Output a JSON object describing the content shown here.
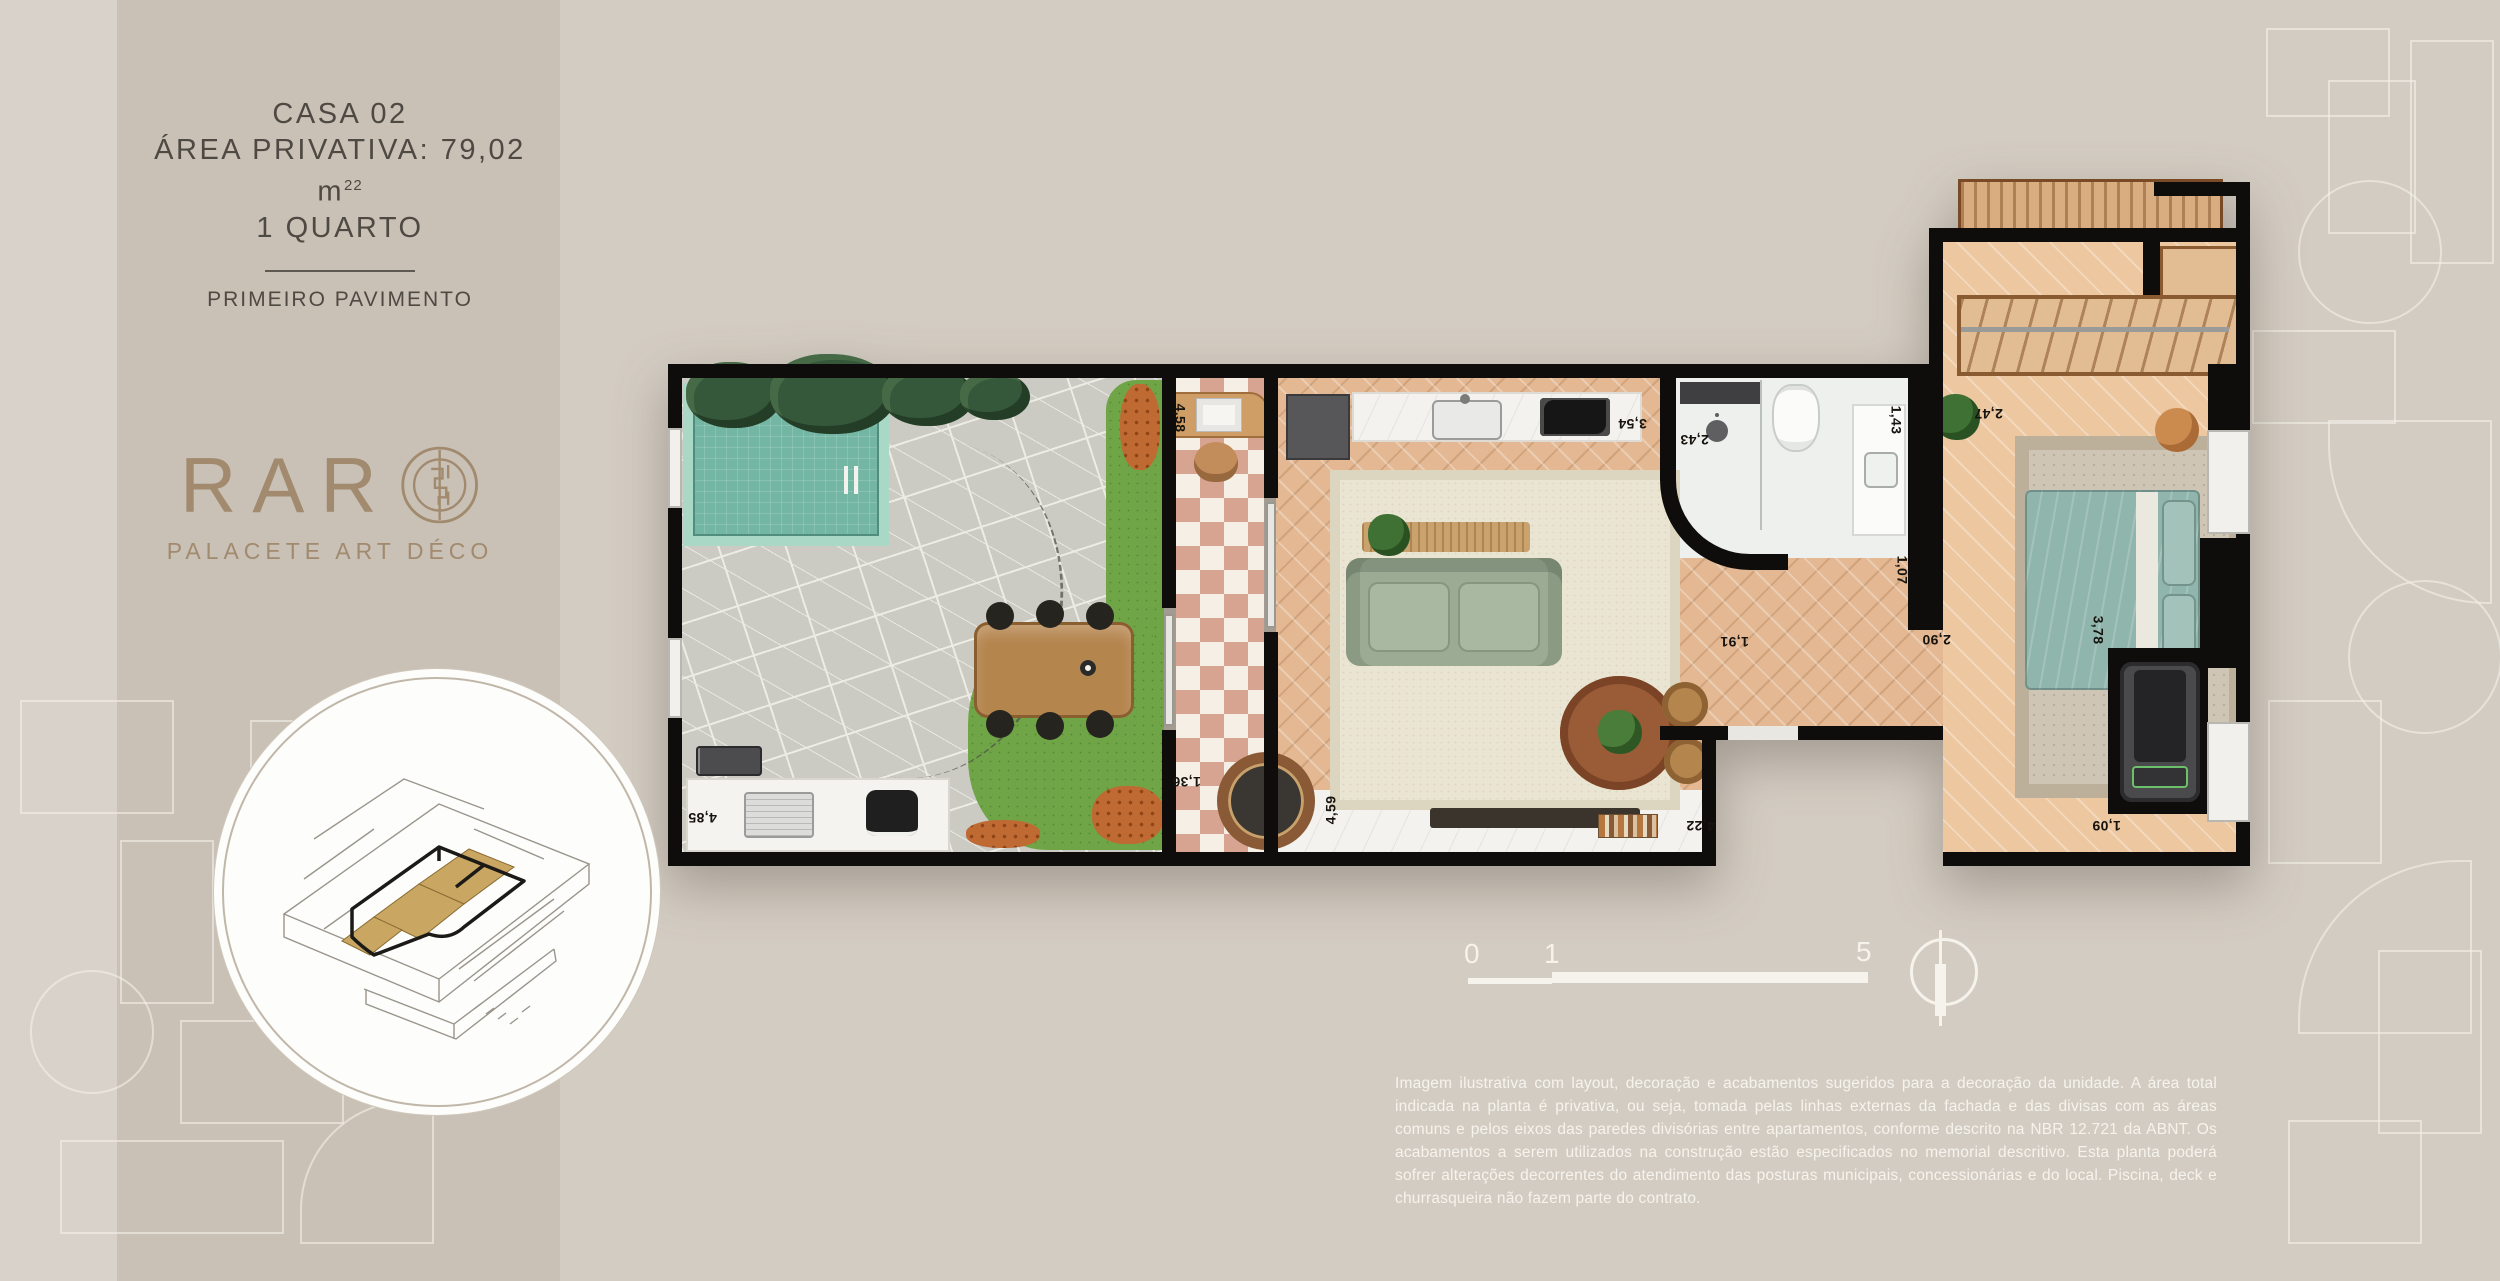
{
  "sidebar": {
    "title_line1": "CASA 02",
    "area_label": "ÁREA PRIVATIVA: 79,02 m",
    "area_sup": "22",
    "title_line3": "1 QUARTO",
    "floor_label": "PRIMEIRO PAVIMENTO",
    "logo_text": "RAR",
    "logo_subtitle": "PALACETE ART DÉCO"
  },
  "plan": {
    "dimensions": {
      "entry_top": "4,58",
      "kitchen": "3,54",
      "shower": "2,43",
      "bath_vanity": "1,43",
      "bath_bottom": "1,07",
      "hall": "1,91",
      "bedroom_hall": "2,90",
      "bedroom_side": "3,78",
      "wardrobe": "2,47",
      "treadmill": "1,09",
      "living_right": "4,22",
      "living_left": "4,59",
      "entry_bottom": "1,36",
      "garden_counter": "4,85"
    }
  },
  "scalebar": {
    "start": "0",
    "mid": "1",
    "end": "5"
  },
  "disclaimer": "Imagem ilustrativa com layout, decoração e acabamentos sugeridos para a decoração da unidade. A área total indicada na planta é privativa, ou seja, tomada pelas linhas externas da fachada e das divisas com as áreas comuns e pelos eixos das paredes divisórias entre apartamentos, conforme descrito na NBR 12.721 da ABNT. Os acabamentos a serem utilizados na construção estão especificados no memorial descritivo. Esta planta poderá sofrer alterações decorrentes do atendimento das posturas municipais, concessionárias e do local. Piscina, deck e churrasqueira não fazem parte do contrato.",
  "colors": {
    "background": "#d3ccc2",
    "panel": "#c9c1b6",
    "accent_bronze": "#a18a6e",
    "wall_black": "#0e0d0b",
    "pool_teal": "#74b6a4",
    "bed_teal": "#8fb5ac",
    "sofa_sage": "#9cab94",
    "wood": "#e3b892",
    "checker_pink": "#d8a492",
    "text_dark": "#4e4a43",
    "text_light": "#f8f6f0"
  }
}
